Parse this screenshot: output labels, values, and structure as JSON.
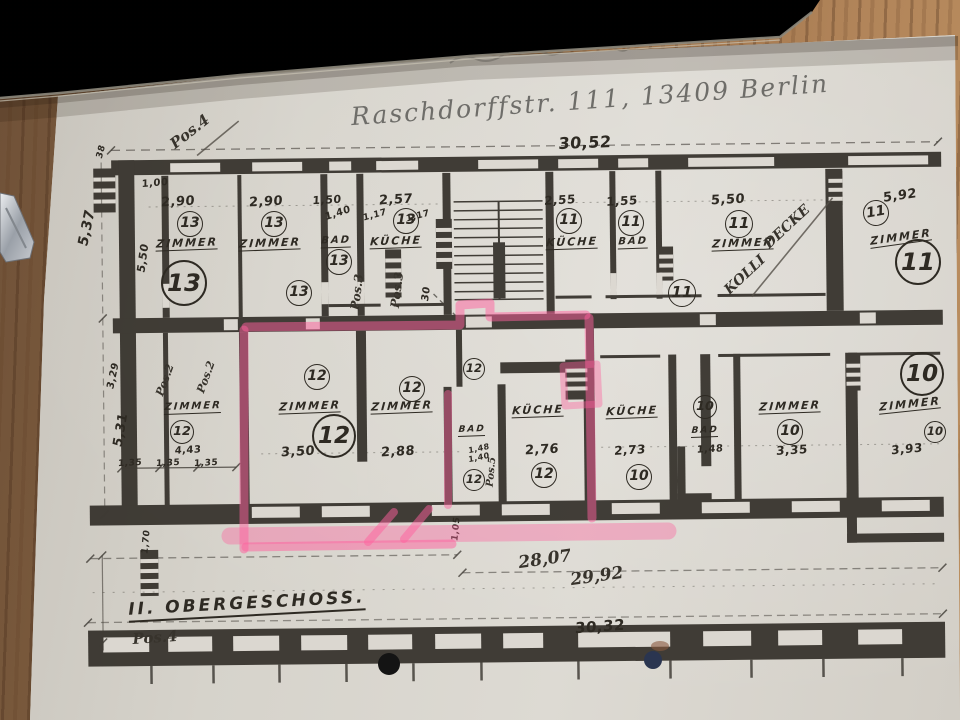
{
  "colors": {
    "ink": "#35312b",
    "paper": "#d6d3cb",
    "highlight": "#ff5f9e",
    "wood": "#8a6544",
    "laptop": "#1b1916"
  },
  "plan": {
    "header": "Raschdorffstr. 111, 13409 Berlin",
    "floor_label": "II. OBERGESCHOSS.",
    "labels": [
      {
        "n": "dim-total-top",
        "t": "30,52",
        "x": 585,
        "y": 143,
        "s": 16,
        "r": -2,
        "k": "d"
      },
      {
        "n": "pos4-top",
        "t": "Pos.4",
        "x": 190,
        "y": 132,
        "s": 15,
        "r": -38,
        "k": "h"
      },
      {
        "n": "dim-537",
        "t": "5,37",
        "x": 87,
        "y": 228,
        "s": 14,
        "r": -78,
        "k": "d"
      },
      {
        "n": "dim-38",
        "t": "38",
        "x": 102,
        "y": 152,
        "s": 9,
        "r": -75,
        "k": "d"
      },
      {
        "n": "dim-100",
        "t": "1,00",
        "x": 155,
        "y": 184,
        "s": 10,
        "r": -5,
        "k": "d"
      },
      {
        "n": "dim-550-left",
        "t": "5,50",
        "x": 143,
        "y": 258,
        "s": 11,
        "r": -82,
        "k": "d"
      },
      {
        "n": "dim-290-a",
        "t": "2,90",
        "x": 178,
        "y": 202,
        "s": 13,
        "r": -3,
        "k": "d"
      },
      {
        "n": "dim-290-b",
        "t": "2,90",
        "x": 266,
        "y": 202,
        "s": 13,
        "r": -3,
        "k": "d"
      },
      {
        "n": "dim-150",
        "t": "1,50",
        "x": 327,
        "y": 200,
        "s": 11,
        "r": -3,
        "k": "d"
      },
      {
        "n": "dim-140",
        "t": "1,40",
        "x": 338,
        "y": 214,
        "s": 10,
        "r": -18,
        "k": "d"
      },
      {
        "n": "dim-257",
        "t": "2,57",
        "x": 396,
        "y": 200,
        "s": 13,
        "r": -3,
        "k": "d"
      },
      {
        "n": "dim-117-a",
        "t": "1,17",
        "x": 375,
        "y": 216,
        "s": 9,
        "r": -15,
        "k": "d"
      },
      {
        "n": "dim-117-b",
        "t": "1,17",
        "x": 418,
        "y": 217,
        "s": 9,
        "r": -15,
        "k": "d"
      },
      {
        "n": "dim-255",
        "t": "2,55",
        "x": 560,
        "y": 200,
        "s": 12,
        "r": -3,
        "k": "d"
      },
      {
        "n": "dim-155",
        "t": "1,55",
        "x": 622,
        "y": 201,
        "s": 12,
        "r": -3,
        "k": "d"
      },
      {
        "n": "dim-550",
        "t": "5,50",
        "x": 728,
        "y": 200,
        "s": 13,
        "r": -3,
        "k": "d"
      },
      {
        "n": "dim-592",
        "t": "5,92",
        "x": 900,
        "y": 196,
        "s": 13,
        "r": -8,
        "k": "d"
      },
      {
        "n": "apt13-circle-1",
        "t": "13",
        "x": 190,
        "y": 224,
        "s": 24,
        "r": 0,
        "k": "c"
      },
      {
        "n": "apt13-circle-2",
        "t": "13",
        "x": 274,
        "y": 224,
        "s": 24,
        "r": 0,
        "k": "c"
      },
      {
        "n": "apt13-circle-3",
        "t": "13",
        "x": 339,
        "y": 262,
        "s": 24,
        "r": 0,
        "k": "c"
      },
      {
        "n": "apt13-circle-4",
        "t": "13",
        "x": 406,
        "y": 221,
        "s": 24,
        "r": 0,
        "k": "c"
      },
      {
        "n": "apt13-circle-big",
        "t": "13",
        "x": 184,
        "y": 283,
        "s": 42,
        "r": 0,
        "k": "C"
      },
      {
        "n": "apt13-circle-5",
        "t": "13",
        "x": 299,
        "y": 293,
        "s": 24,
        "r": 0,
        "k": "c"
      },
      {
        "n": "apt11-circle-1",
        "t": "11",
        "x": 569,
        "y": 221,
        "s": 24,
        "r": 0,
        "k": "c"
      },
      {
        "n": "apt11-circle-2",
        "t": "11",
        "x": 631,
        "y": 223,
        "s": 24,
        "r": 0,
        "k": "c"
      },
      {
        "n": "apt11-circle-3",
        "t": "11",
        "x": 739,
        "y": 224,
        "s": 26,
        "r": 0,
        "k": "c"
      },
      {
        "n": "apt11-circle-4",
        "t": "11",
        "x": 682,
        "y": 293,
        "s": 26,
        "r": 0,
        "k": "c"
      },
      {
        "n": "apt11-circle-5",
        "t": "11",
        "x": 876,
        "y": 213,
        "s": 24,
        "r": -10,
        "k": "c"
      },
      {
        "n": "apt11-circle-big",
        "t": "11",
        "x": 918,
        "y": 262,
        "s": 42,
        "r": 0,
        "k": "C"
      },
      {
        "n": "room-zimmer-13a",
        "t": "ZIMMER",
        "x": 187,
        "y": 244,
        "s": 11,
        "r": -2,
        "k": "r"
      },
      {
        "n": "room-zimmer-13b",
        "t": "ZIMMER",
        "x": 270,
        "y": 244,
        "s": 11,
        "r": -2,
        "k": "r"
      },
      {
        "n": "room-bad-13",
        "t": "BAD",
        "x": 336,
        "y": 242,
        "s": 10,
        "r": -2,
        "k": "r"
      },
      {
        "n": "room-kueche-13",
        "t": "KÜCHE",
        "x": 396,
        "y": 242,
        "s": 11,
        "r": -2,
        "k": "r"
      },
      {
        "n": "room-kueche-11",
        "t": "KÜCHE",
        "x": 572,
        "y": 243,
        "s": 11,
        "r": -2,
        "k": "r"
      },
      {
        "n": "room-bad-11",
        "t": "BAD",
        "x": 633,
        "y": 243,
        "s": 10,
        "r": -2,
        "k": "r"
      },
      {
        "n": "room-zimmer-11a",
        "t": "ZIMMER",
        "x": 743,
        "y": 244,
        "s": 11,
        "r": -2,
        "k": "r"
      },
      {
        "n": "room-zimmer-11b",
        "t": "ZIMMER",
        "x": 901,
        "y": 238,
        "s": 11,
        "r": -8,
        "k": "r"
      },
      {
        "n": "note-decke",
        "t": "DECKE",
        "x": 787,
        "y": 227,
        "s": 14,
        "r": -43,
        "k": "h"
      },
      {
        "n": "note-kolli",
        "t": "KOLLI",
        "x": 745,
        "y": 275,
        "s": 14,
        "r": -43,
        "k": "h"
      },
      {
        "n": "pos3-a",
        "t": "Pos.3",
        "x": 357,
        "y": 292,
        "s": 12,
        "r": -83,
        "k": "h"
      },
      {
        "n": "pos3-b",
        "t": "Pos.3",
        "x": 397,
        "y": 290,
        "s": 12,
        "r": -83,
        "k": "h"
      },
      {
        "n": "dim-30-vert",
        "t": "30",
        "x": 427,
        "y": 294,
        "s": 10,
        "r": -83,
        "k": "d"
      },
      {
        "n": "pos2-a",
        "t": "Pos.2",
        "x": 165,
        "y": 380,
        "s": 11,
        "r": -70,
        "k": "h"
      },
      {
        "n": "pos2-b",
        "t": "Pos.2",
        "x": 206,
        "y": 377,
        "s": 11,
        "r": -70,
        "k": "h"
      },
      {
        "n": "dim-329",
        "t": "3,29",
        "x": 114,
        "y": 376,
        "s": 10,
        "r": -78,
        "k": "d"
      },
      {
        "n": "dim-531",
        "t": "5,31",
        "x": 121,
        "y": 430,
        "s": 13,
        "r": -80,
        "k": "d"
      },
      {
        "n": "room-zimmer-12a",
        "t": "ZIMMER",
        "x": 193,
        "y": 408,
        "s": 10,
        "r": -2,
        "k": "r"
      },
      {
        "n": "apt12-circle-1",
        "t": "12",
        "x": 182,
        "y": 432,
        "s": 22,
        "r": 0,
        "k": "c"
      },
      {
        "n": "dim-443",
        "t": "4,43",
        "x": 188,
        "y": 451,
        "s": 10,
        "r": -3,
        "k": "d"
      },
      {
        "n": "dim-135-a",
        "t": "1,35",
        "x": 130,
        "y": 464,
        "s": 9,
        "r": -3,
        "k": "d"
      },
      {
        "n": "dim-135-b",
        "t": "1,35",
        "x": 168,
        "y": 464,
        "s": 9,
        "r": -3,
        "k": "d"
      },
      {
        "n": "dim-135-c",
        "t": "1,35",
        "x": 206,
        "y": 464,
        "s": 9,
        "r": -3,
        "k": "d"
      },
      {
        "n": "apt12-circle-2",
        "t": "12",
        "x": 317,
        "y": 377,
        "s": 24,
        "r": 0,
        "k": "c"
      },
      {
        "n": "room-zimmer-12b",
        "t": "ZIMMER",
        "x": 310,
        "y": 407,
        "s": 11,
        "r": -2,
        "k": "r"
      },
      {
        "n": "apt12-circle-big",
        "t": "12",
        "x": 334,
        "y": 436,
        "s": 40,
        "r": 0,
        "k": "C"
      },
      {
        "n": "dim-350",
        "t": "3,50",
        "x": 298,
        "y": 452,
        "s": 13,
        "r": -3,
        "k": "d"
      },
      {
        "n": "apt12-circle-3",
        "t": "12",
        "x": 412,
        "y": 389,
        "s": 24,
        "r": 0,
        "k": "c"
      },
      {
        "n": "room-zimmer-12c",
        "t": "ZIMMER",
        "x": 402,
        "y": 407,
        "s": 11,
        "r": -2,
        "k": "r"
      },
      {
        "n": "dim-288",
        "t": "2,88",
        "x": 398,
        "y": 452,
        "s": 13,
        "r": -3,
        "k": "d"
      },
      {
        "n": "apt12-circle-4",
        "t": "12",
        "x": 474,
        "y": 369,
        "s": 20,
        "r": 0,
        "k": "c"
      },
      {
        "n": "room-bad-12",
        "t": "BAD",
        "x": 472,
        "y": 431,
        "s": 9,
        "r": -2,
        "k": "r"
      },
      {
        "n": "dim-148-a",
        "t": "1,48",
        "x": 479,
        "y": 449,
        "s": 8,
        "r": -12,
        "k": "d"
      },
      {
        "n": "dim-140-b",
        "t": "1,40",
        "x": 479,
        "y": 458,
        "s": 8,
        "r": -12,
        "k": "d"
      },
      {
        "n": "apt12-circle-5",
        "t": "12",
        "x": 474,
        "y": 480,
        "s": 20,
        "r": 0,
        "k": "c"
      },
      {
        "n": "pos5-vert",
        "t": "Pos.5",
        "x": 492,
        "y": 472,
        "s": 10,
        "r": -85,
        "k": "h"
      },
      {
        "n": "room-kueche-12",
        "t": "KÜCHE",
        "x": 538,
        "y": 411,
        "s": 11,
        "r": -2,
        "k": "r"
      },
      {
        "n": "dim-276",
        "t": "2,76",
        "x": 542,
        "y": 450,
        "s": 13,
        "r": -3,
        "k": "d"
      },
      {
        "n": "apt12-circle-6",
        "t": "12",
        "x": 544,
        "y": 475,
        "s": 24,
        "r": 0,
        "k": "c"
      },
      {
        "n": "room-kueche-10",
        "t": "KÜCHE",
        "x": 632,
        "y": 412,
        "s": 11,
        "r": -2,
        "k": "r"
      },
      {
        "n": "dim-273",
        "t": "2,73",
        "x": 630,
        "y": 450,
        "s": 12,
        "r": -3,
        "k": "d"
      },
      {
        "n": "apt10-circle-1",
        "t": "10",
        "x": 639,
        "y": 477,
        "s": 24,
        "r": 0,
        "k": "c"
      },
      {
        "n": "apt10-circle-2",
        "t": "10",
        "x": 705,
        "y": 407,
        "s": 22,
        "r": 0,
        "k": "c"
      },
      {
        "n": "room-bad-10",
        "t": "BAD",
        "x": 705,
        "y": 432,
        "s": 9,
        "r": -2,
        "k": "r"
      },
      {
        "n": "dim-148-b",
        "t": "1,48",
        "x": 710,
        "y": 450,
        "s": 10,
        "r": -3,
        "k": "d"
      },
      {
        "n": "room-zimmer-10a",
        "t": "ZIMMER",
        "x": 790,
        "y": 407,
        "s": 11,
        "r": -2,
        "k": "r"
      },
      {
        "n": "apt10-circle-3",
        "t": "10",
        "x": 790,
        "y": 432,
        "s": 24,
        "r": 0,
        "k": "c"
      },
      {
        "n": "dim-335",
        "t": "3,35",
        "x": 792,
        "y": 450,
        "s": 12,
        "r": -3,
        "k": "d"
      },
      {
        "n": "apt10-circle-big",
        "t": "10",
        "x": 922,
        "y": 374,
        "s": 40,
        "r": 0,
        "k": "C"
      },
      {
        "n": "room-zimmer-10b",
        "t": "ZIMMER",
        "x": 910,
        "y": 405,
        "s": 11,
        "r": -6,
        "k": "r"
      },
      {
        "n": "apt10-circle-4",
        "t": "10",
        "x": 935,
        "y": 432,
        "s": 20,
        "r": 0,
        "k": "c"
      },
      {
        "n": "dim-393",
        "t": "3,93",
        "x": 907,
        "y": 449,
        "s": 12,
        "r": -5,
        "k": "d"
      },
      {
        "n": "dim-170-vert",
        "t": "1,70",
        "x": 147,
        "y": 542,
        "s": 9,
        "r": -85,
        "k": "d"
      },
      {
        "n": "dim-105-vert",
        "t": "1,05",
        "x": 457,
        "y": 529,
        "s": 9,
        "r": -85,
        "k": "d"
      },
      {
        "n": "dim-2807",
        "t": "28,07",
        "x": 545,
        "y": 560,
        "s": 17,
        "r": -8,
        "k": "h"
      },
      {
        "n": "dim-2992",
        "t": "29,92",
        "x": 597,
        "y": 577,
        "s": 17,
        "r": -8,
        "k": "h"
      },
      {
        "n": "pos4-bottom",
        "t": "Pos.4",
        "x": 155,
        "y": 638,
        "s": 15,
        "r": -4,
        "k": "h"
      },
      {
        "n": "dim-3032",
        "t": "30,32",
        "x": 600,
        "y": 627,
        "s": 15,
        "r": -4,
        "k": "d"
      }
    ]
  }
}
